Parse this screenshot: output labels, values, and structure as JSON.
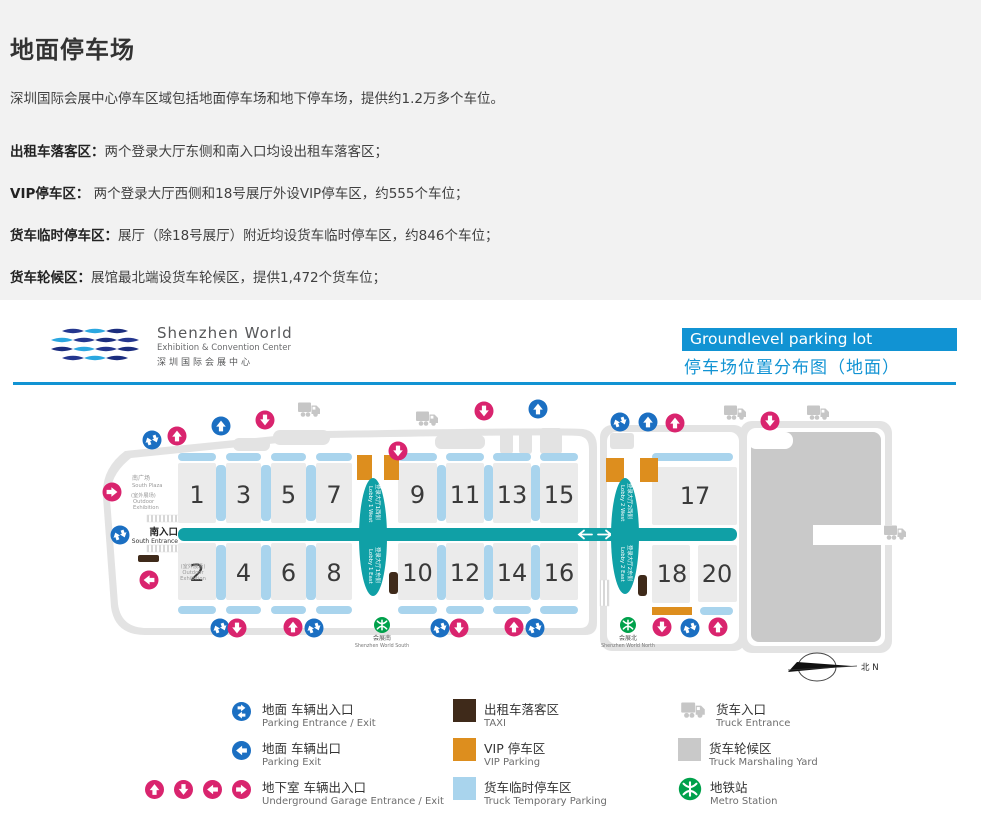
{
  "page": {
    "title": "地面停车场",
    "intro": "深圳国际会展中心停车区域包括地面停车场和地下停车场，提供约1.2万多个车位。",
    "zones": [
      {
        "label": "出租车落客区：",
        "text": "两个登录大厅东侧和南入口均设出租车落客区；"
      },
      {
        "label": "VIP停车区：",
        "text": " 两个登录大厅西侧和18号展厅外设VIP停车区，约555个车位；"
      },
      {
        "label": "货车临时停车区：",
        "text": "展厅（除18号展厅）附近均设货车临时停车区，约846个车位；"
      },
      {
        "label": "货车轮候区：",
        "text": "展馆最北端设货车轮候区，提供1,472个货车位；"
      }
    ]
  },
  "logo": {
    "name": "Shenzhen World",
    "subtitle": "Exhibition & Convention Center",
    "cn": "深圳国际会展中心"
  },
  "banner": {
    "title_en": "Groundlevel parking lot",
    "title_cn": "停车场位置分布图（地面）"
  },
  "map": {
    "halls": [
      "1",
      "3",
      "5",
      "7",
      "9",
      "11",
      "13",
      "15",
      "17",
      "2",
      "4",
      "6",
      "8",
      "10",
      "12",
      "14",
      "16",
      "18",
      "20"
    ],
    "labels": {
      "south_plaza_cn": "南广场",
      "south_plaza_en": "South Plaza",
      "outdoor_cn": "(室外展场)",
      "outdoor_en1": "Outdoor",
      "outdoor_en2": "Exhibition",
      "south_entrance_cn": "南入口",
      "south_entrance_en": "South Entrance",
      "lobby1_west_cn": "登录大厅1西侧",
      "lobby1_west_en": "Lobby 1 West",
      "lobby1_east_cn": "登录大厅1东侧",
      "lobby1_east_en": "Lobby 1 East",
      "lobby2_west_cn": "登录大厅2西侧",
      "lobby2_west_en": "Lobby 2 West",
      "lobby2_east_cn": "登录大厅2东侧",
      "lobby2_east_en": "Lobby 2 East",
      "metro_south_cn": "会展南",
      "metro_south_en": "Shenzhen World South",
      "metro_north_cn": "会展北",
      "metro_north_en": "Shenzhen World North",
      "north": "北 N"
    }
  },
  "legend": {
    "col1": [
      {
        "cn": "地面 车辆出入口",
        "en": "Parking Entrance / Exit"
      },
      {
        "cn": "地面 车辆出口",
        "en": "Parking Exit"
      },
      {
        "cn": "地下室 车辆出入口",
        "en": "Underground Garage Entrance / Exit"
      }
    ],
    "col2": [
      {
        "cn": "出租车落客区",
        "en": "TAXI"
      },
      {
        "cn": "VIP 停车区",
        "en": "VIP Parking"
      },
      {
        "cn": "货车临时停车区",
        "en": "Truck Temporary Parking"
      }
    ],
    "col3": [
      {
        "cn": "货车入口",
        "en": "Truck Entrance"
      },
      {
        "cn": "货车轮候区",
        "en": "Truck Marshaling Yard"
      },
      {
        "cn": "地铁站",
        "en": "Metro Station"
      }
    ]
  },
  "colors": {
    "banner_blue": "#1193d3",
    "corridor_teal": "#10a0a6",
    "truck_temp_blue": "#a9d4ed",
    "vip_orange": "#dd8e1e",
    "taxi_brown": "#3f2a1a",
    "underground_pink": "#d9246e",
    "entrance_blue": "#1b6fc2",
    "metro_green": "#00a14b",
    "yard_gray": "#c9c9c9"
  }
}
